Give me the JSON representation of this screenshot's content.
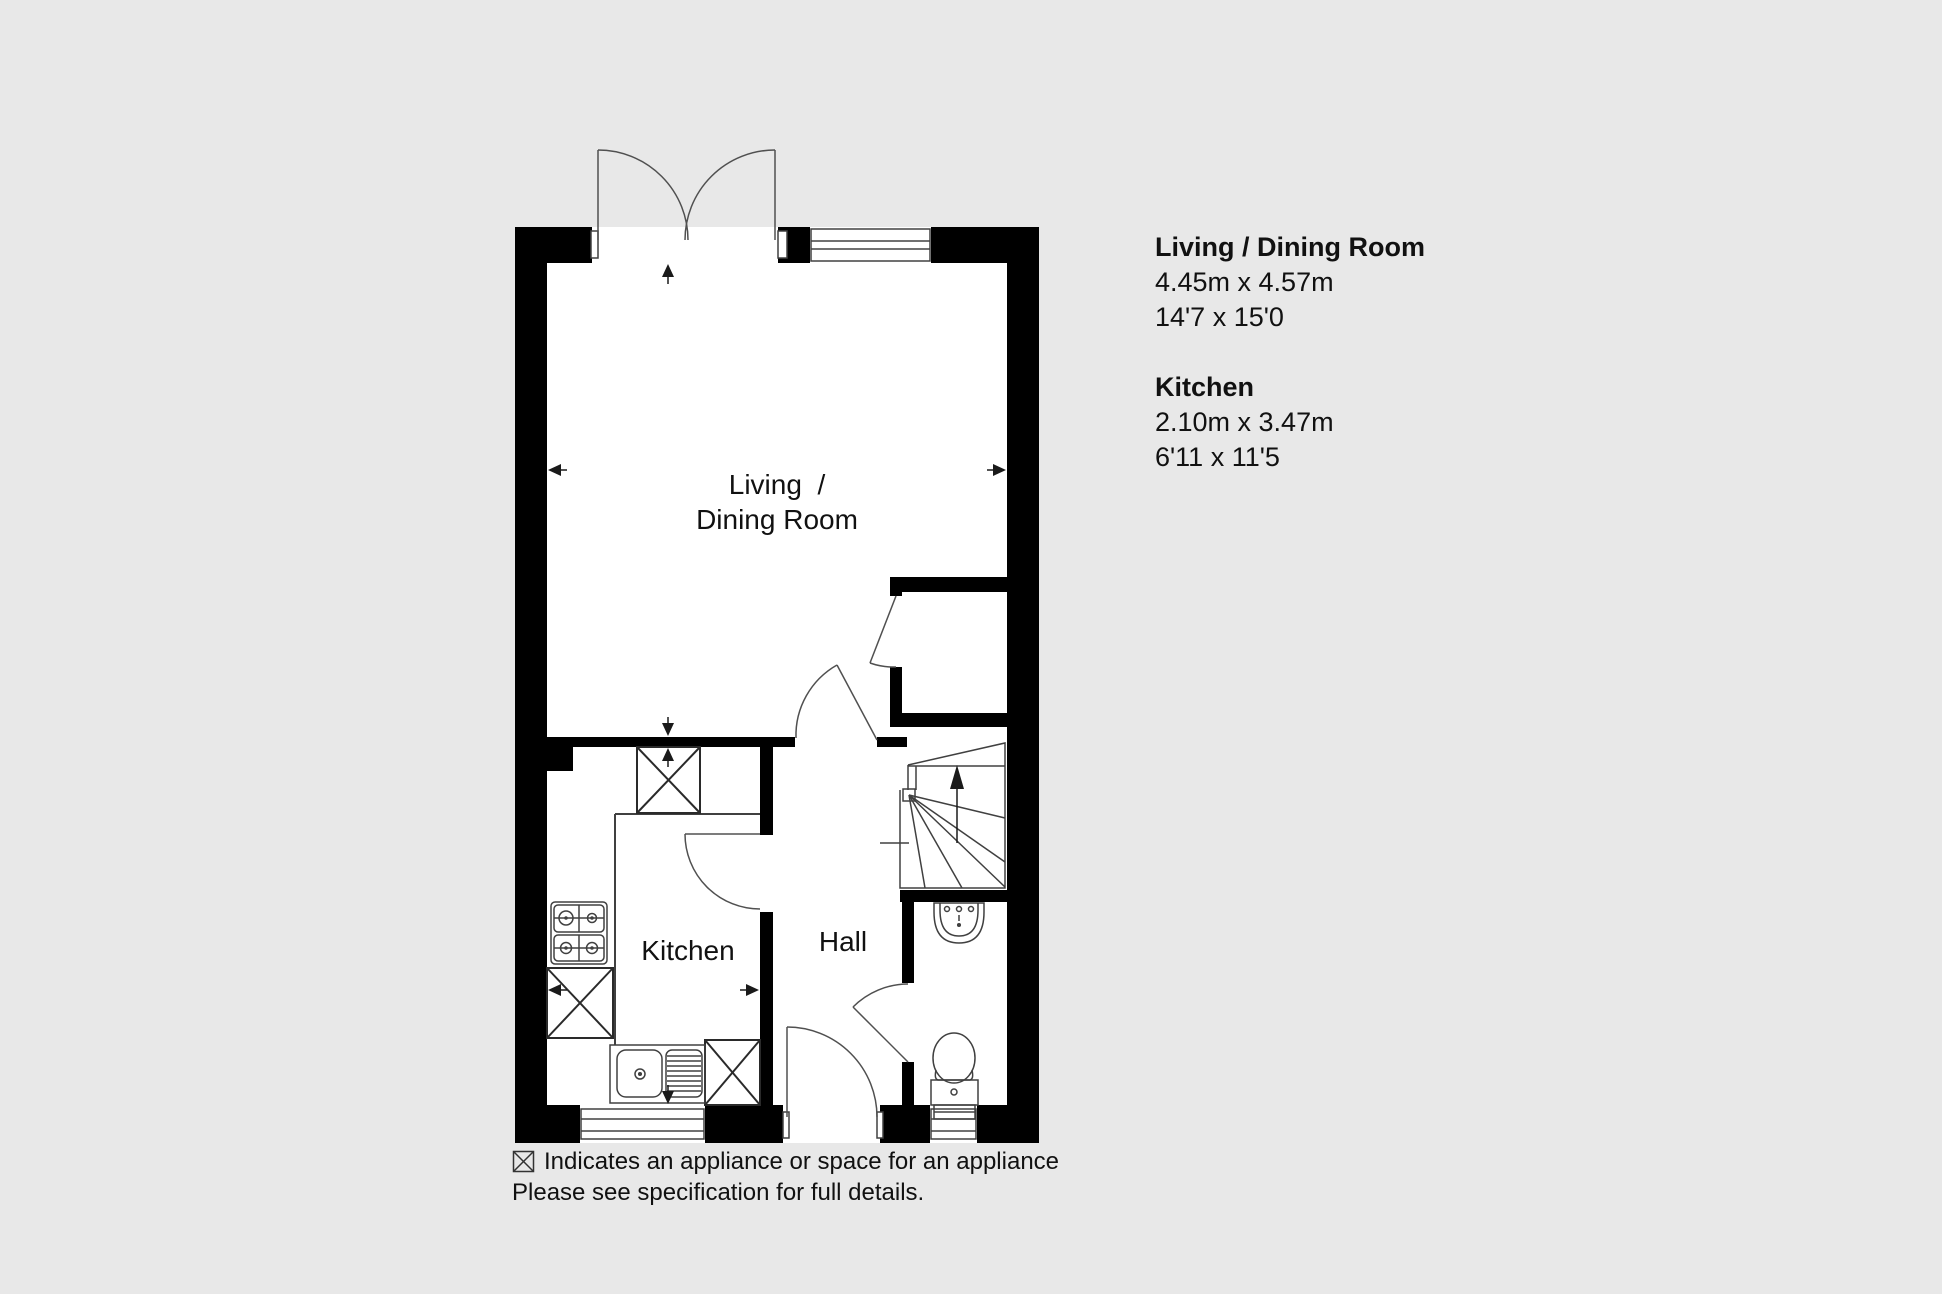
{
  "colors": {
    "background": "#e8e8e8",
    "wall": "#000000",
    "thin_line": "#404040",
    "floor": "#ffffff",
    "text": "#111111"
  },
  "plan": {
    "labels": {
      "living_line1": "Living  /",
      "living_line2": "Dining Room",
      "kitchen": "Kitchen",
      "hall": "Hall"
    },
    "features": [
      "double-entrance-doors-top",
      "living-room-window-top",
      "under-stairs-cupboard",
      "winder-staircase-up",
      "wc-with-basin-and-toilet",
      "kitchen-with-hob-sink-and-appliance-spaces",
      "kitchen-window-bottom",
      "front-door-bottom",
      "wc-window-bottom"
    ]
  },
  "dimensions_panel": {
    "sections": [
      {
        "title": "Living / Dining Room",
        "metric": "4.45m x 4.57m",
        "imperial": "14'7 x 15'0"
      },
      {
        "title": "Kitchen",
        "metric": "2.10m x 3.47m",
        "imperial": "6'11 x 11'5"
      }
    ]
  },
  "legend": {
    "symbol": "appliance-box-icon",
    "line1": "Indicates an appliance or space for an appliance",
    "line2": "Please see specification for full details."
  }
}
